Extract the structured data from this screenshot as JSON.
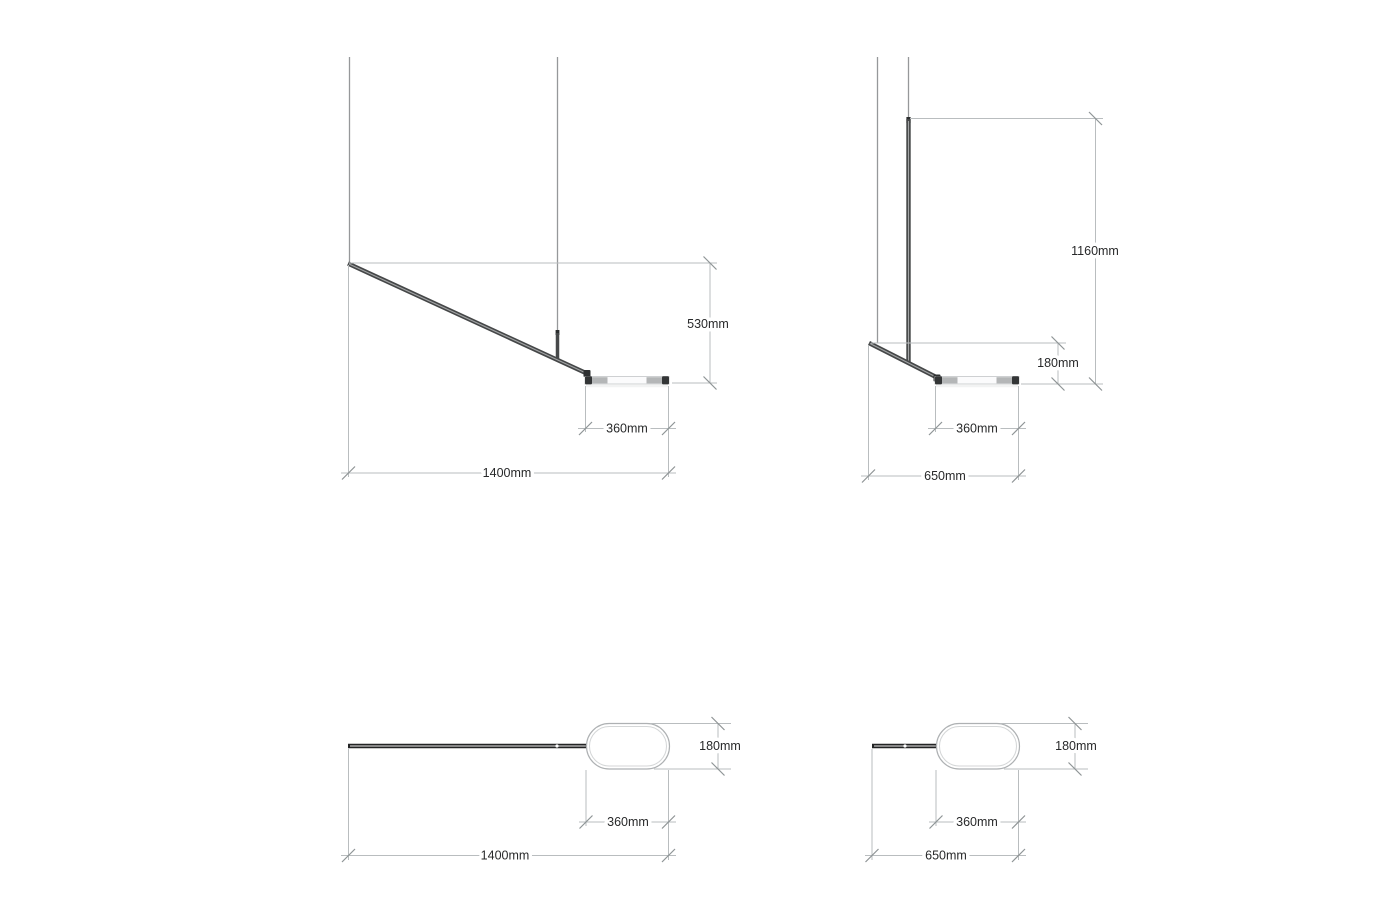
{
  "document": {
    "type": "pendant-lamp dimension drawing",
    "unit": "mm",
    "background": "#ffffff"
  },
  "colors": {
    "dimension_line": "#b9bdbf",
    "tick": "#8f9496",
    "label_text": "#28292a",
    "cable": "#96989a",
    "bar_dark": "#454748",
    "bar_highlight": "#a2a4a5",
    "cap_dark": "#2b2d2e",
    "shade_cap": "#333536",
    "shade_segment": "#b4b6b7",
    "shade_face": "#fbfbfc",
    "plan_rod": "#232425",
    "oval_outline": "#aeb1b3",
    "oval_inner_line": "#d4d6d7"
  },
  "views": [
    {
      "name": "side-view-long",
      "labels": {
        "height": "530mm",
        "shade_width": "360mm",
        "overall_width": "1400mm"
      }
    },
    {
      "name": "side-view-short",
      "labels": {
        "height": "1160mm",
        "head_drop": "180mm",
        "shade_width": "360mm",
        "overall_width": "650mm"
      }
    },
    {
      "name": "plan-view-long",
      "labels": {
        "shade_depth": "180mm",
        "shade_width": "360mm",
        "overall_width": "1400mm"
      }
    },
    {
      "name": "plan-view-short",
      "labels": {
        "shade_depth": "180mm",
        "shade_width": "360mm",
        "overall_width": "650mm"
      }
    }
  ]
}
